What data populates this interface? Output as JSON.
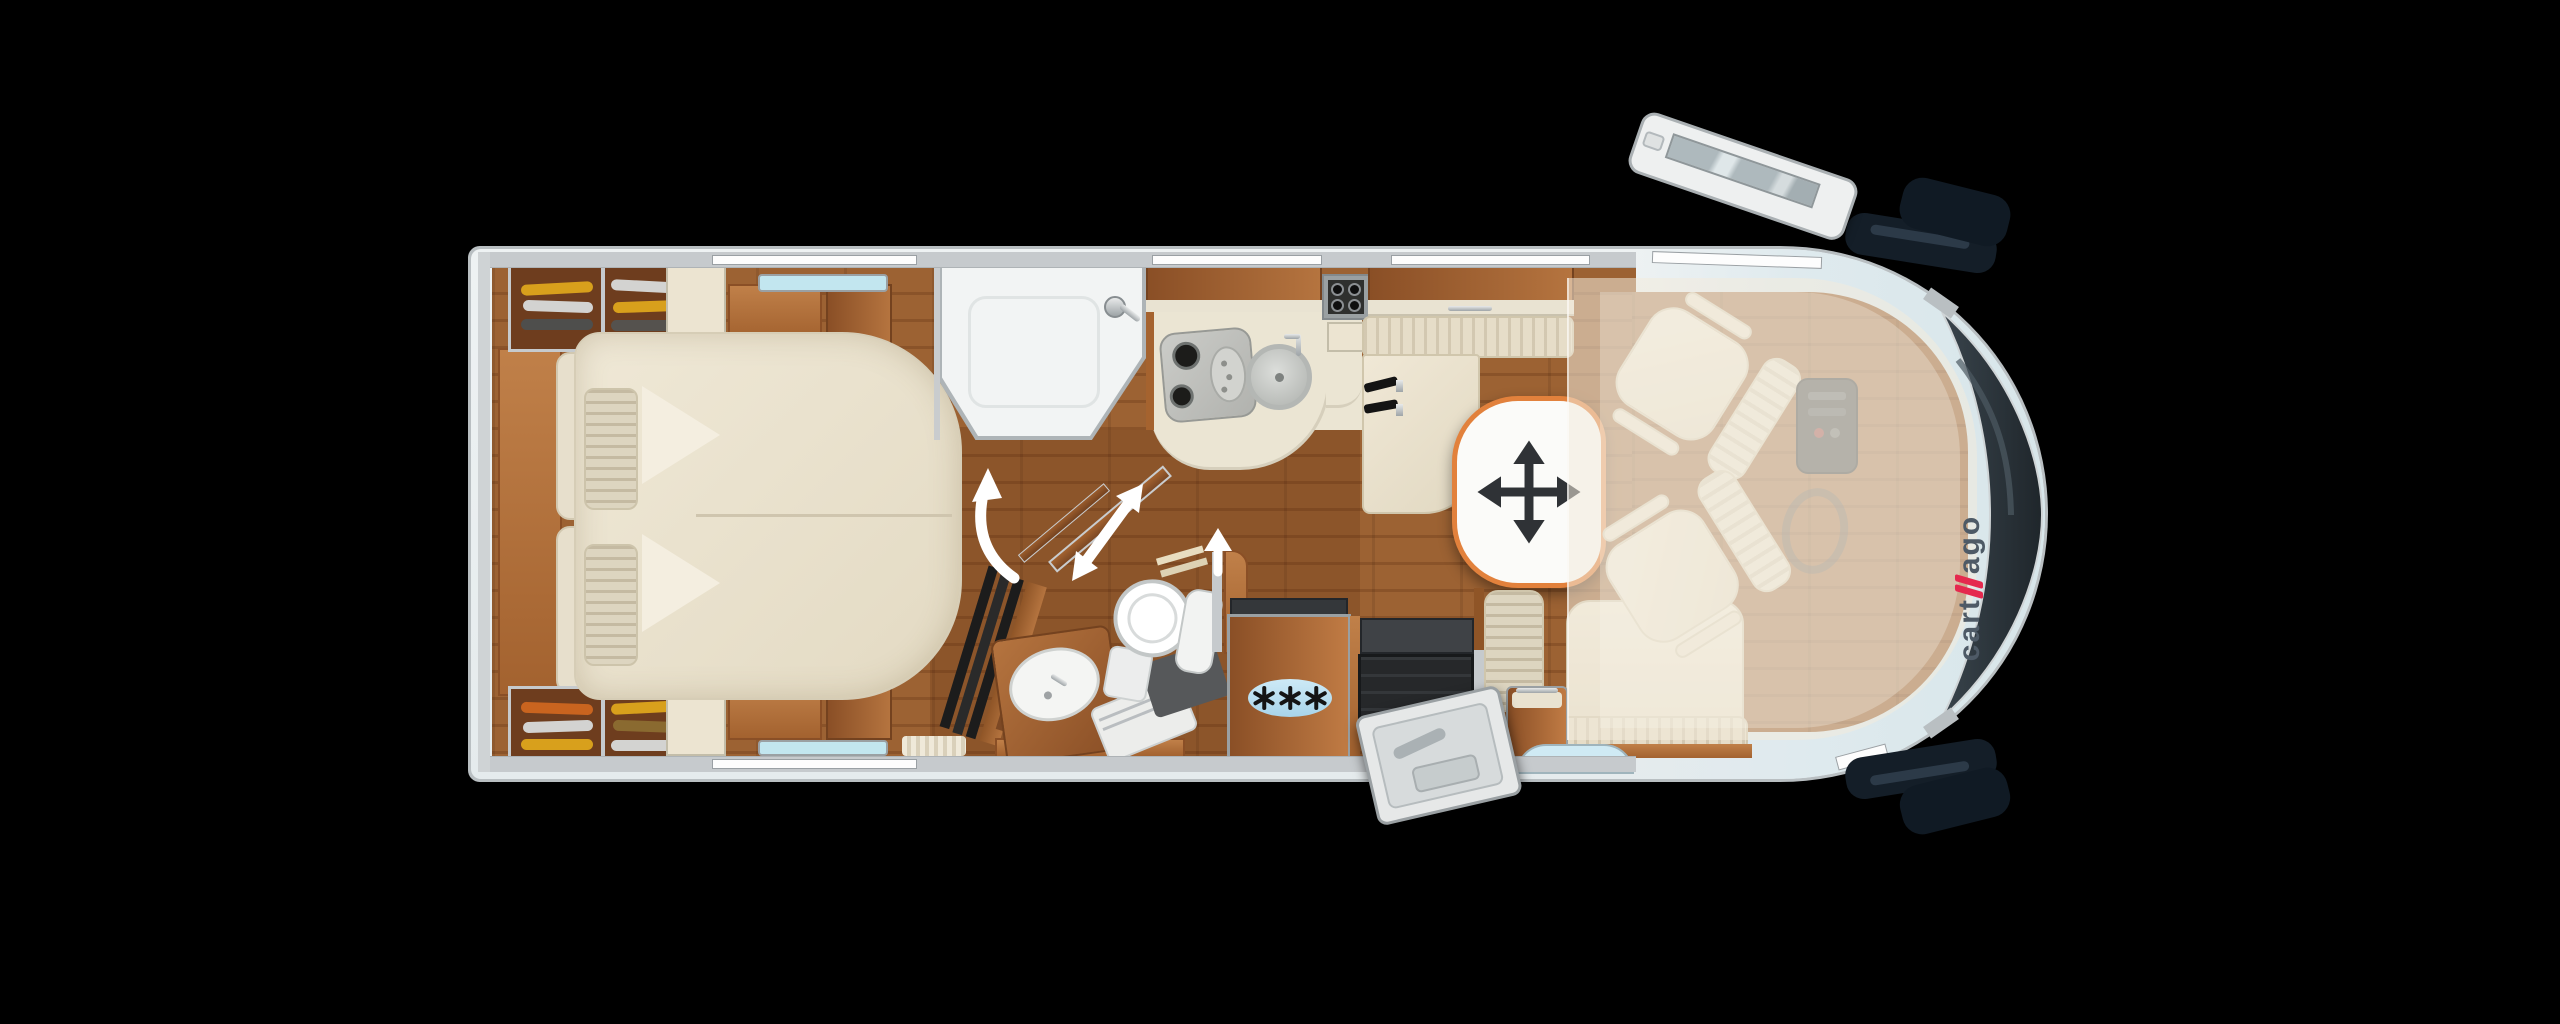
{
  "brand": {
    "name": "carthago",
    "logo_text_start": "cart",
    "logo_text_end": "ago"
  },
  "appliances": {
    "freezer_star_count": 3
  },
  "table": {
    "icon": "move-4way-arrow",
    "border_color": "#e2813c"
  },
  "door_swing_arrows": {
    "bathroom_door": "curved-arrow-up",
    "swivel_wall": "double-headed-diagonal-arrow",
    "toilet_door": "straight-arrow-up"
  },
  "palette": {
    "background": "#000000",
    "body_white": "#edf1f2",
    "wall_gray": "#c6cacd",
    "wood_light": "#b5743f",
    "wood_dark": "#7c4824",
    "floor_wood": "#96603a",
    "upholstery_cream": "#ece4d1",
    "counter_cream": "#ebe5d3",
    "accent_orange": "#e2813c",
    "freezer_blue": "#bfe2f4",
    "rooflight_blue": "#c2e6ef",
    "logo_gray": "#4e5a66",
    "logo_red": "#e5294e",
    "windshield_dark": "#2b343a"
  }
}
